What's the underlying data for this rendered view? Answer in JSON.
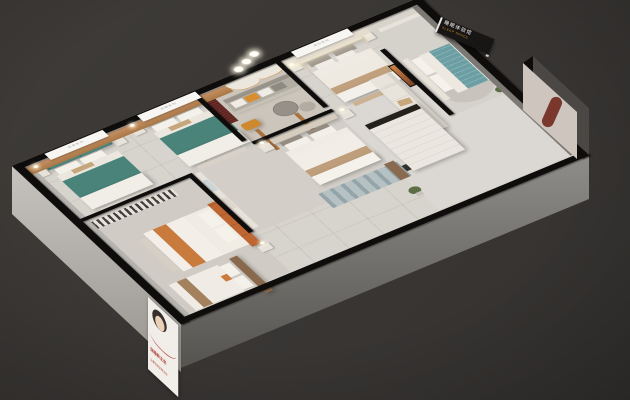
{
  "scene": {
    "description": "3D axonometric render of a bedding showroom floor plan with six display bedrooms, a lounge with wavy feature wall, TV partition, and exterior advertising",
    "background_color": "#393634"
  },
  "sign": {
    "cn": "睡眠体验馆",
    "en": "SLEEP SPACE"
  },
  "banners": {
    "a": "轻奢系列",
    "b": "舒眠系列",
    "c": "简约系列"
  },
  "poster": {
    "headline": "深睡新主张",
    "subline": "全屋软装定制体验"
  },
  "palette": {
    "background": "#393634",
    "floor": "#d7d3cd",
    "wall_top": "#0e0d0c",
    "accent_wall_tan": "#bd8756",
    "bed_teal": "#4a857c",
    "bed_blue": "#6c9fa3",
    "bed_orange": "#be6732",
    "runner_orange": "#c97a3d",
    "cabinet_dark_red": "#6b2d28",
    "arch_niche_red": "#79372e",
    "sofa_gray": "#b3aea4",
    "cream": "#f2eee7",
    "sign_bg": "#181614",
    "sign_accent": "#d28c36",
    "poster_red": "#b5443a"
  }
}
